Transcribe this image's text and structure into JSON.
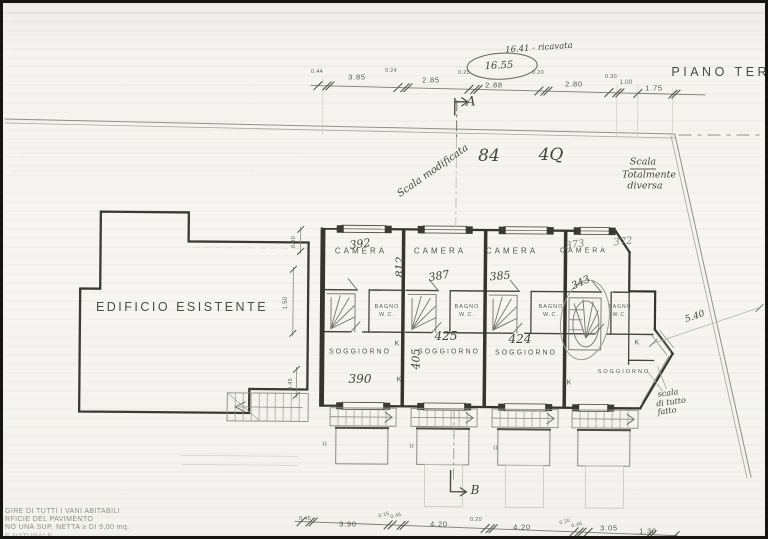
{
  "header": {
    "title": "PIANO TERR"
  },
  "handwritten": {
    "note_ricavata": "16.41 - ricavata",
    "total_dim": "16.55",
    "big_left": "84",
    "big_right": "4Q",
    "scala_diag": "Scala modificata",
    "scala_right": [
      "Scala",
      "Totalmente",
      "diversa"
    ],
    "scala_bottom": [
      "scala",
      "di tutto",
      "fatto"
    ],
    "dim_diag": "5.40",
    "areas": [
      "392",
      "812",
      "387",
      "385",
      "373",
      "372",
      "343",
      "425",
      "424",
      "405",
      "390"
    ]
  },
  "sections": {
    "a": "A",
    "b": "B"
  },
  "rooms": {
    "existing": "EDIFICIO ESISTENTE",
    "camera": [
      "CAMERA",
      "CAMERA",
      "CAMERA",
      "CAMERA"
    ],
    "bagno_label": "BAGNO",
    "wc_label": "W.C.",
    "soggiorno": [
      "SOGGIORNO",
      "SOGGIORNO",
      "SOGGIORNO",
      "SOGGIORNO"
    ],
    "kitchen_label": "K",
    "porch_mark": "II"
  },
  "dimensions": {
    "top": [
      "0.44",
      "3.85",
      "0.24",
      "2.85",
      "0.20",
      "2.88",
      "0.20",
      "2.80",
      "0.30",
      "1.00",
      "1.75"
    ],
    "bottom": [
      "0.45",
      "3.90",
      "0.15",
      "0.45",
      "4.20",
      "0.20",
      "4.20",
      "0.20",
      "0.45",
      "3.05",
      "1.30"
    ],
    "left": [
      "0.90",
      "1.50",
      "0.45"
    ]
  },
  "footnotes": [
    "GIRE DI TUTTI I VANI ABITABILI",
    "RFICIE DEL PAVIMENTO",
    "NO UNA SUP. NETTA ≥ DI 9,00 mq.",
    "E NATURALE"
  ]
}
